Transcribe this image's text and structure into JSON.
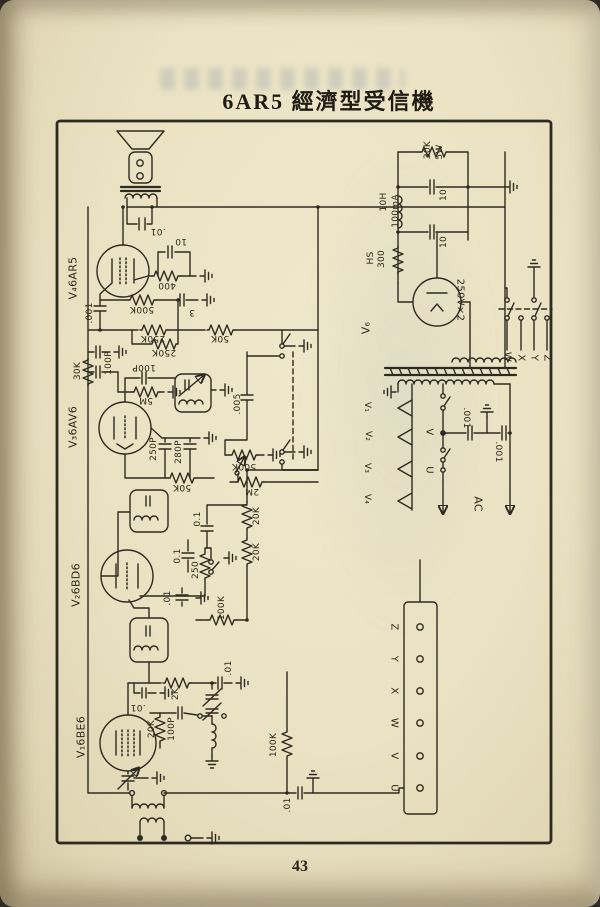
{
  "page": {
    "title": "6AR5 經濟型受信機",
    "page_number": "43"
  },
  "schematic": {
    "description": "6AR5 economy-type radio receiver circuit diagram",
    "labels": [
      {
        "text": "30K",
        "x": 428,
        "y": 150,
        "rot": -90
      },
      {
        "text": "5W",
        "x": 440,
        "y": 152,
        "rot": -90
      },
      {
        "text": "10",
        "x": 444,
        "y": 195,
        "rot": -90
      },
      {
        "text": "10",
        "x": 444,
        "y": 242,
        "rot": -90
      },
      {
        "text": "10H",
        "x": 384,
        "y": 202,
        "rot": -90
      },
      {
        "text": "100mA",
        "x": 396,
        "y": 211,
        "rot": -90
      },
      {
        "text": "HS",
        "x": 371,
        "y": 258,
        "rot": -90
      },
      {
        "text": "300",
        "x": 382,
        "y": 259,
        "rot": -90
      },
      {
        "text": "V₆",
        "x": 366,
        "y": 328,
        "rot": -90,
        "size": 11
      },
      {
        "text": "250V×2",
        "x": 460,
        "y": 300,
        "rot": 90,
        "size": 10
      },
      {
        "text": "W",
        "x": 507,
        "y": 357,
        "rot": 90,
        "size": 10
      },
      {
        "text": "X",
        "x": 521,
        "y": 358,
        "rot": 90,
        "size": 10
      },
      {
        "text": "Y",
        "x": 534,
        "y": 358,
        "rot": 90,
        "size": 10
      },
      {
        "text": "Z",
        "x": 547,
        "y": 358,
        "rot": 90,
        "size": 10
      },
      {
        "text": "V₁",
        "x": 367,
        "y": 407,
        "rot": 90
      },
      {
        "text": "V₂",
        "x": 368,
        "y": 436,
        "rot": 90
      },
      {
        "text": "V₃",
        "x": 367,
        "y": 468,
        "rot": 90
      },
      {
        "text": "V₄",
        "x": 367,
        "y": 499,
        "rot": 90
      },
      {
        "text": ".001",
        "x": 466,
        "y": 418,
        "rot": 90
      },
      {
        "text": ".001",
        "x": 498,
        "y": 452,
        "rot": 90
      },
      {
        "text": "V",
        "x": 429,
        "y": 432,
        "rot": 90,
        "size": 10
      },
      {
        "text": "U",
        "x": 429,
        "y": 470,
        "rot": 90,
        "size": 10
      },
      {
        "text": "AC",
        "x": 478,
        "y": 504,
        "rot": 90,
        "size": 11
      },
      {
        "text": "Z",
        "x": 394,
        "y": 627,
        "rot": 90,
        "size": 10
      },
      {
        "text": "Y",
        "x": 394,
        "y": 659,
        "rot": 90,
        "size": 10
      },
      {
        "text": "X",
        "x": 394,
        "y": 691,
        "rot": 90,
        "size": 10
      },
      {
        "text": "W",
        "x": 394,
        "y": 723,
        "rot": 90,
        "size": 10
      },
      {
        "text": "V",
        "x": 394,
        "y": 756,
        "rot": 90,
        "size": 10
      },
      {
        "text": "U",
        "x": 394,
        "y": 788,
        "rot": 90,
        "size": 10
      },
      {
        "text": ".01",
        "x": 158,
        "y": 231,
        "rot": 180
      },
      {
        "text": "10",
        "x": 181,
        "y": 241,
        "rot": 180
      },
      {
        "text": "400",
        "x": 167,
        "y": 285,
        "rot": 180
      },
      {
        "text": "V₄6AR5",
        "x": 73,
        "y": 278,
        "rot": -90,
        "size": 11
      },
      {
        "text": ".001",
        "x": 90,
        "y": 313,
        "rot": -90
      },
      {
        "text": "500K",
        "x": 142,
        "y": 309,
        "rot": 180
      },
      {
        "text": "3",
        "x": 192,
        "y": 312,
        "rot": 180
      },
      {
        "text": "250K",
        "x": 153,
        "y": 338,
        "rot": 180
      },
      {
        "text": "50K",
        "x": 220,
        "y": 338,
        "rot": 180
      },
      {
        "text": "250K",
        "x": 164,
        "y": 352,
        "rot": 180
      },
      {
        "text": "100P",
        "x": 109,
        "y": 363,
        "rot": -90
      },
      {
        "text": "30K",
        "x": 78,
        "y": 371,
        "rot": -90
      },
      {
        "text": "100P",
        "x": 144,
        "y": 367,
        "rot": 180
      },
      {
        "text": "5M",
        "x": 146,
        "y": 400,
        "rot": 180
      },
      {
        "text": "V₃6AV6",
        "x": 73,
        "y": 427,
        "rot": -90,
        "size": 11
      },
      {
        "text": ".005",
        "x": 238,
        "y": 404,
        "rot": -90
      },
      {
        "text": "250P",
        "x": 154,
        "y": 449,
        "rot": -90
      },
      {
        "text": "280P",
        "x": 179,
        "y": 452,
        "rot": -90
      },
      {
        "text": "50K",
        "x": 182,
        "y": 487,
        "rot": 180
      },
      {
        "text": "500K",
        "x": 244,
        "y": 466,
        "rot": 180
      },
      {
        "text": "2M",
        "x": 252,
        "y": 491,
        "rot": 180
      },
      {
        "text": "20K",
        "x": 257,
        "y": 516,
        "rot": -90
      },
      {
        "text": "20K",
        "x": 257,
        "y": 552,
        "rot": -90
      },
      {
        "text": "0.1",
        "x": 198,
        "y": 519,
        "rot": -90
      },
      {
        "text": "0.1",
        "x": 178,
        "y": 556,
        "rot": -90
      },
      {
        "text": "250",
        "x": 196,
        "y": 570,
        "rot": -90
      },
      {
        "text": ".01",
        "x": 168,
        "y": 598,
        "rot": -90
      },
      {
        "text": "100K",
        "x": 222,
        "y": 608,
        "rot": -90
      },
      {
        "text": "V₂6BD6",
        "x": 76,
        "y": 585,
        "rot": -90,
        "size": 11
      },
      {
        "text": ".01",
        "x": 229,
        "y": 668,
        "rot": -90
      },
      {
        "text": "2K",
        "x": 176,
        "y": 694,
        "rot": -90
      },
      {
        "text": ".01",
        "x": 138,
        "y": 707,
        "rot": 180
      },
      {
        "text": "20K",
        "x": 152,
        "y": 729,
        "rot": -90
      },
      {
        "text": "100P",
        "x": 172,
        "y": 729,
        "rot": -90
      },
      {
        "text": "V₁6BE6",
        "x": 81,
        "y": 737,
        "rot": -90,
        "size": 11
      },
      {
        "text": "100K",
        "x": 274,
        "y": 745,
        "rot": -90
      },
      {
        "text": ".01",
        "x": 288,
        "y": 805,
        "rot": -90
      }
    ]
  }
}
